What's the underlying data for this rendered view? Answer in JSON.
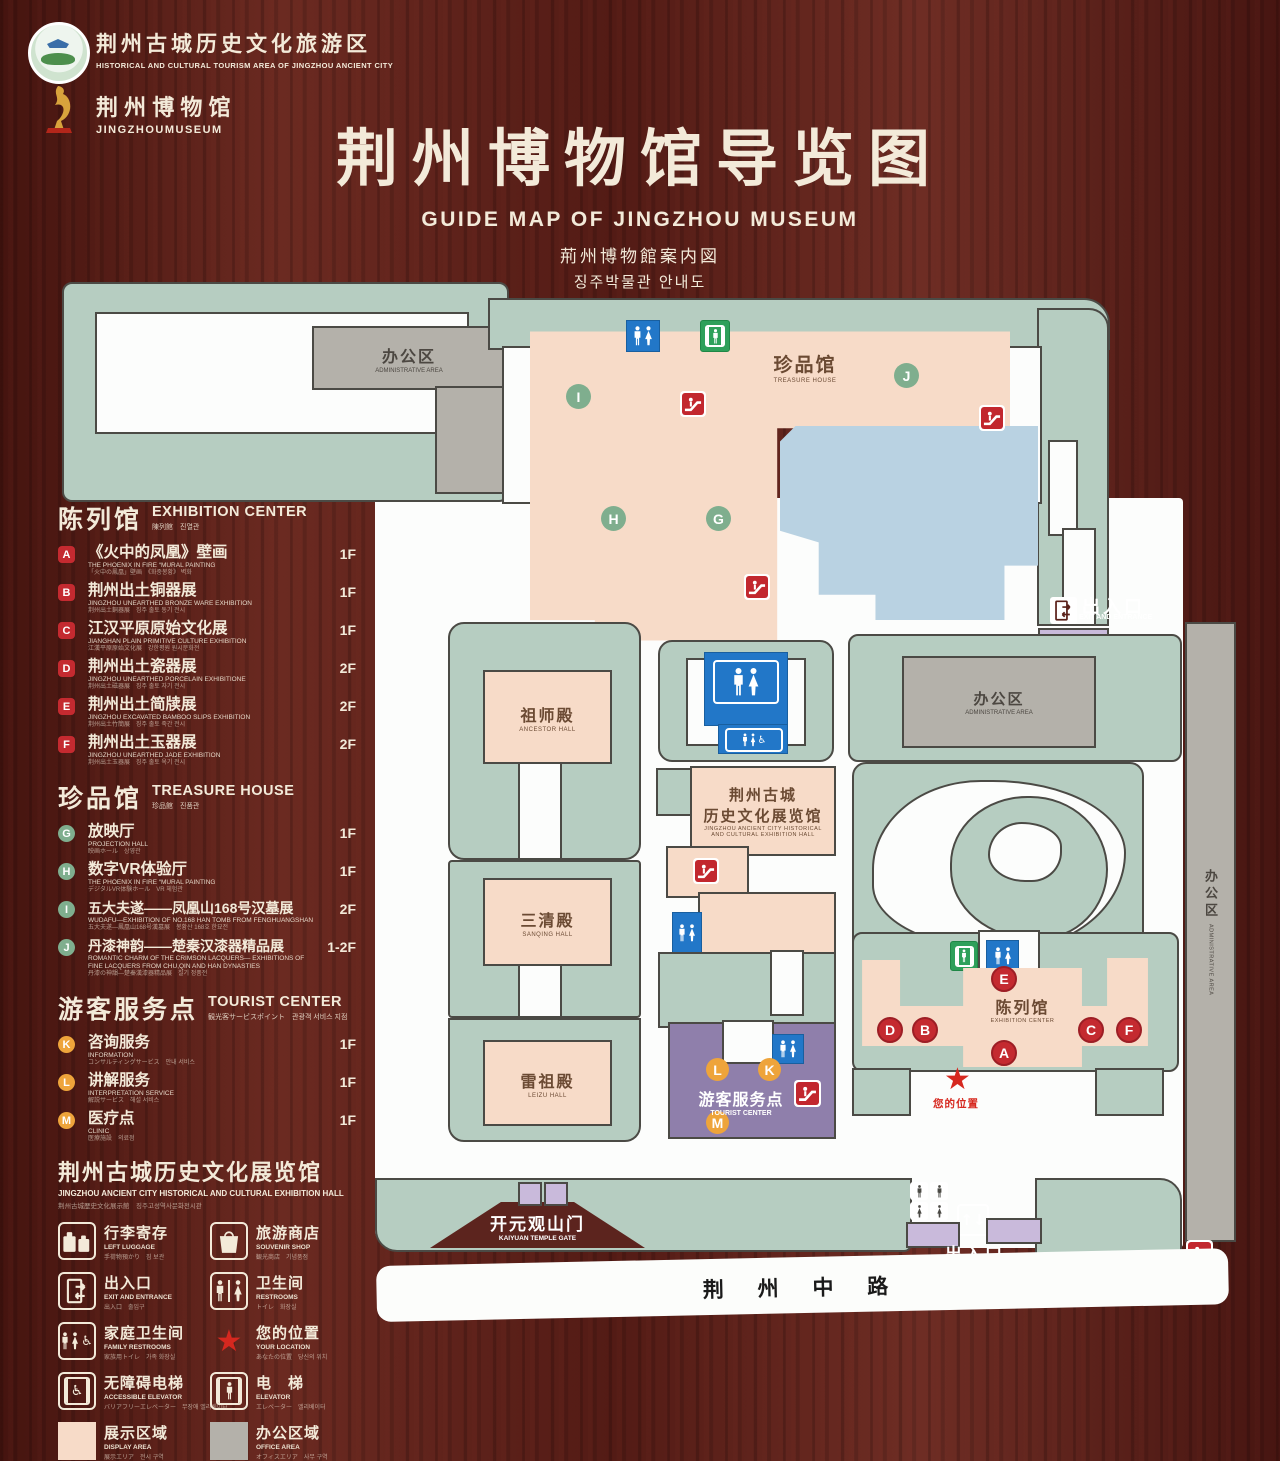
{
  "palette": {
    "wood": "#5a2019",
    "cream": "#f3ead9",
    "map_green": "#b6cdc1",
    "path_white": "#fcfdfc",
    "building_pink": "#f7dbc8",
    "building_gray": "#b4b1aa",
    "pond_blue": "#b9d2e2",
    "tourist_purple": "#8f7fab",
    "gate_purple": "#c9badb",
    "sign_blue": "#2277c8",
    "sign_green": "#2ea05a",
    "marker_red": "#c42a30",
    "marker_green": "#7fae8e",
    "marker_orange": "#eea43b",
    "star_red": "#d6281f",
    "outline": "#4b4a45"
  },
  "icons": {
    "restroom": "man-woman-figures",
    "elevator": "person-in-doors",
    "escalator": "red-steps-figure",
    "exit": "door-with-arrows",
    "luggage": "two-suitcases",
    "souvenir": "shopping-bag",
    "location": "red-star",
    "accessible": "wheelchair-symbol",
    "updown": "up-down-arrows"
  },
  "header": {
    "badge1_zh": "荆州古城历史文化旅游区",
    "badge1_en": "HISTORICAL AND CULTURAL TOURISM AREA OF JINGZHOU ANCIENT CITY",
    "badge2_zh": "荆 州 博 物 馆",
    "badge2_en": "JINGZHOUMUSEUM",
    "title_zh": "荆州博物馆导览图",
    "title_en": "GUIDE MAP OF JINGZHOU MUSEUM",
    "title_ja": "荊州博物館案内図",
    "title_ko": "징주박물관 안내도"
  },
  "legend": {
    "sections": [
      {
        "title_zh": "陈列馆",
        "title_en": "EXHIBITION CENTER",
        "title_sub": "陳列館　진열관",
        "items": [
          {
            "letter": "A",
            "zh": "《火中的凤凰》壁画",
            "en": "THE PHOENIX IN FIRE “MURAL PAINTING",
            "sub": "「火中の鳳凰」壁画　《화중봉황》 벽화",
            "floor": "1F"
          },
          {
            "letter": "B",
            "zh": "荆州出土铜器展",
            "en": "JINGZHOU UNEARTHED BRONZE WARE EXHIBITION",
            "sub": "荆州出土銅器展　징주 출토 동기 전시",
            "floor": "1F"
          },
          {
            "letter": "C",
            "zh": "江汉平原原始文化展",
            "en": "JIANGHAN PLAIN PRIMITIVE CULTURE EXHIBITION",
            "sub": "江漢平原原始文化展　강한평원 원시문화전",
            "floor": "1F"
          },
          {
            "letter": "D",
            "zh": "荆州出土瓷器展",
            "en": "JINGZHOU UNEARTHED PORCELAIN EXHIBITIONE",
            "sub": "荆州出土磁器展　징주 출토 자기 전시",
            "floor": "2F"
          },
          {
            "letter": "E",
            "zh": "荆州出土简牍展",
            "en": "JINGZHOU EXCAVATED BAMBOO SLIPS EXHIBITION",
            "sub": "荆州出土竹簡展　징주 출토 죽간 전시",
            "floor": "2F"
          },
          {
            "letter": "F",
            "zh": "荆州出土玉器展",
            "en": "JINGZHOU UNEARTHED JADE EXHIBITION",
            "sub": "荆州出土玉器展　징주 출토 옥기 전시",
            "floor": "2F"
          }
        ]
      },
      {
        "title_zh": "珍品馆",
        "title_en": "TREASURE HOUSE",
        "title_sub": "珍品館　진품관",
        "items": [
          {
            "letter": "G",
            "zh": "放映厅",
            "en": "PROJECTION HALL",
            "sub": "映画ホール　상영관",
            "floor": "1F"
          },
          {
            "letter": "H",
            "zh": "数字VR体验厅",
            "en": "THE PHOENIX IN FIRE “MURAL PAINTING",
            "sub": "デジタルVR体験ホール　VR 체험관",
            "floor": "1F"
          },
          {
            "letter": "I",
            "zh": "五大夫遂——凤凰山168号汉墓展",
            "en": "WUDAFU—EXHIBITION OF NO.168 HAN TOMB FROM FENGHUANGSHAN",
            "sub": "五大夫遂—鳳凰山168号漢墓展　봉황산 168호 한묘전",
            "floor": "2F"
          },
          {
            "letter": "J",
            "zh": "丹漆神韵——楚秦汉漆器精品展",
            "en": "ROMANTIC CHARM OF THE CRIMSON LACQUERS— EXHIBITIONS OF FINE LACQUERS FROM CHU,QIN AND HAN DYNASTIES",
            "sub": "丹漆の神韻—楚秦漢漆器精品展　칠기 정품전",
            "floor": "1-2F"
          }
        ]
      },
      {
        "title_zh": "游客服务点",
        "title_en": "TOURIST CENTER",
        "title_sub": "観光客サービスポイント　관광객 서비스 지점",
        "items": [
          {
            "letter": "K",
            "zh": "咨询服务",
            "en": "INFORMATION",
            "sub": "コンサルティングサービス　안내 서비스",
            "floor": "1F"
          },
          {
            "letter": "L",
            "zh": "讲解服务",
            "en": "INTERPRETATION SERVICE",
            "sub": "解説サービス　해설 서비스",
            "floor": "1F"
          },
          {
            "letter": "M",
            "zh": "医疗点",
            "en": "CLINIC",
            "sub": "医療施設　의료점",
            "floor": "1F"
          }
        ]
      }
    ],
    "hall_note": {
      "zh": "荆州古城历史文化展览馆",
      "en": "JINGZHOU ANCIENT CITY HISTORICAL AND CULTURAL EXHIBITION HALL",
      "sub": "荆州古城歴史文化展示館　징주고성역사문화전시관"
    },
    "symbols": [
      {
        "zh": "行李寄存",
        "en": "LEFT LUGGAGE",
        "sub": "手荷物預かり　짐 보관",
        "icon": "luggage-icon"
      },
      {
        "zh": "旅游商店",
        "en": "SOUVENIR SHOP",
        "sub": "観光商店　기념품점",
        "icon": "shopping-bag-icon"
      },
      {
        "zh": "出入口",
        "en": "EXIT AND ENTRANCE",
        "sub": "出入口　출입구",
        "icon": "exit-door-icon"
      },
      {
        "zh": "卫生间",
        "en": "RESTROOMS",
        "sub": "トイレ　화장실",
        "icon": "restroom-icon"
      },
      {
        "zh": "家庭卫生间",
        "en": "FAMILY RESTROOMS",
        "sub": "家族用トイレ　가족 화장실",
        "icon": "family-restroom-icon"
      },
      {
        "zh": "您的位置",
        "en": "YOUR LOCATION",
        "sub": "あなたの位置　당신의 위치",
        "icon": "location-star-icon"
      },
      {
        "zh": "无障碍电梯",
        "en": "ACCESSIBLE ELEVATOR",
        "sub": "バリアフリーエレベーター　무장애 엘리베이터",
        "icon": "accessible-elevator-icon"
      },
      {
        "zh": "电　梯",
        "en": "ELEVATOR",
        "sub": "エレベーター　엘리베이터",
        "icon": "elevator-icon"
      }
    ],
    "areas": [
      {
        "zh": "展示区域",
        "en": "DISPLAY AREA",
        "sub": "展示エリア　전시 구역",
        "color": "#f7dbc8"
      },
      {
        "zh": "办公区域",
        "en": "OFFICE AREA",
        "sub": "オフィスエリア　사무 구역",
        "color": "#b4b1aa"
      }
    ]
  },
  "map": {
    "admin_nw": {
      "zh": "办公区",
      "en": "ADMINISTRATIVE AREA"
    },
    "treasure": {
      "zh": "珍品馆",
      "en": "TREASURE HOUSE"
    },
    "ancestor": {
      "zh": "祖师殿",
      "en": "ANCESTOR HALL"
    },
    "sanqing": {
      "zh": "三清殿",
      "en": "SANQING HALL"
    },
    "leizu": {
      "zh": "雷祖殿",
      "en": "LEIZU HALL"
    },
    "hist_hall": {
      "zh1": "荆州古城",
      "zh2": "历史文化展览馆",
      "en1": "JINGZHOU ANCIENT CITY HISTORICAL",
      "en2": "AND CULTURAL EXHIBITION HALL"
    },
    "tourist": {
      "zh": "游客服务点",
      "en": "TOURIST CENTER"
    },
    "admin_e": {
      "zh": "办公区",
      "en": "ADMINISTRATIVE AREA"
    },
    "admin_strip": {
      "zh": "办公区",
      "en": "ADMINISTRATIVE AREA"
    },
    "exhibition": {
      "zh": "陈列馆",
      "en": "EXHIBITION CENTER"
    },
    "gate": {
      "zh": "开元观山门",
      "en": "KAIYUAN TEMPLE GATE"
    },
    "exit_ne": {
      "zh": "出入口",
      "en": "EXIT AND ENTRANCE"
    },
    "exit_s": {
      "zh": "出入口",
      "en": "EXIT AND ENTRANCE"
    },
    "road": "荆 州 中 路",
    "you_location": "您的位置",
    "letters": {
      "A": "A",
      "B": "B",
      "C": "C",
      "D": "D",
      "E": "E",
      "F": "F",
      "G": "G",
      "H": "H",
      "I": "I",
      "J": "J",
      "K": "K",
      "L": "L",
      "M": "M"
    }
  }
}
